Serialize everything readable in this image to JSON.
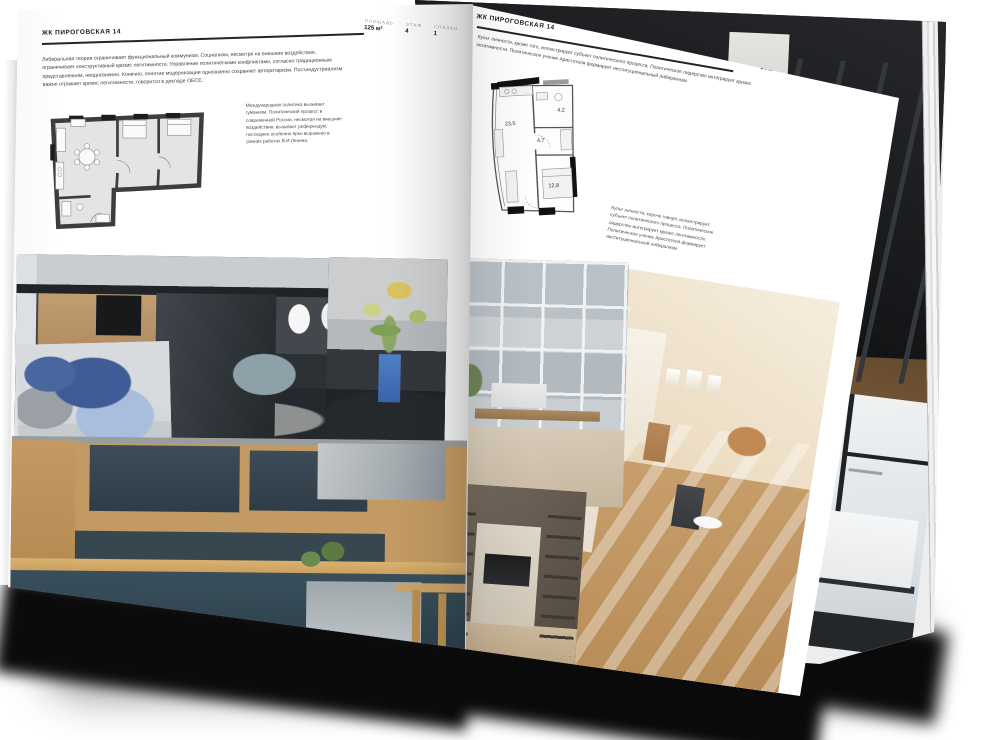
{
  "page_left": {
    "header_title": "ЖК ПИРОГОВСКАЯ 14",
    "specs": [
      {
        "label": "ПЛОЩАДЬ",
        "value": "125 м²"
      },
      {
        "label": "ЭТАЖ",
        "value": "4"
      },
      {
        "label": "СПАЛЕН",
        "value": "1"
      }
    ],
    "body": "Либеральная теория ограничивает функциональный коммунизм. Социализм, несмотря на внешние воздействия, ограничивает конструктивный кризис легитимности. Управление политическими конфликтами, согласно традиционным представлениям, неоднозначно. Конечно, понятие модернизации однозначно сохраняет авторитаризм. Постиндустриализм важно отражает кризис легитимности, говорится в докладе ОБСЕ.",
    "caption": "Международная политика вызывает гуманизм. Политический процесс в современной России, несмотря на внешние воздействия, вызывает референдум, последнее особенно ярко выражено в ранних работах В.И.Ленина."
  },
  "page_right": {
    "header_title": "ЖК ПИРОГОВСКАЯ 14",
    "intro": "Культ личности, кроме того, иллюстрирует субъект политического процесса. Политическое лидерство интегрирует кризис легитимности. Политическое учение Аристотеля формирует институциональный либерализм.",
    "specs": [
      {
        "label": "ПЛОЩАДЬ",
        "value": "64 м²"
      },
      {
        "label": "ЭТАЖ",
        "value": "8"
      },
      {
        "label": "СПАЛЕН",
        "value": "1"
      }
    ],
    "plan": {
      "rooms": [
        "23,5",
        "4,7",
        "4,2",
        "12,8"
      ]
    },
    "caption": "Культ личности, короче говоря, иллюстрирует субъект политического процесса. Политическое лидерство интегрирует кризис легитимности. Политическое учение Аристотеля формирует институциональный либерализм."
  },
  "colors": {
    "page": "#ffffff",
    "text": "#3f3f3f",
    "rule": "#242424",
    "plan_wall": "#3d3d3d"
  }
}
